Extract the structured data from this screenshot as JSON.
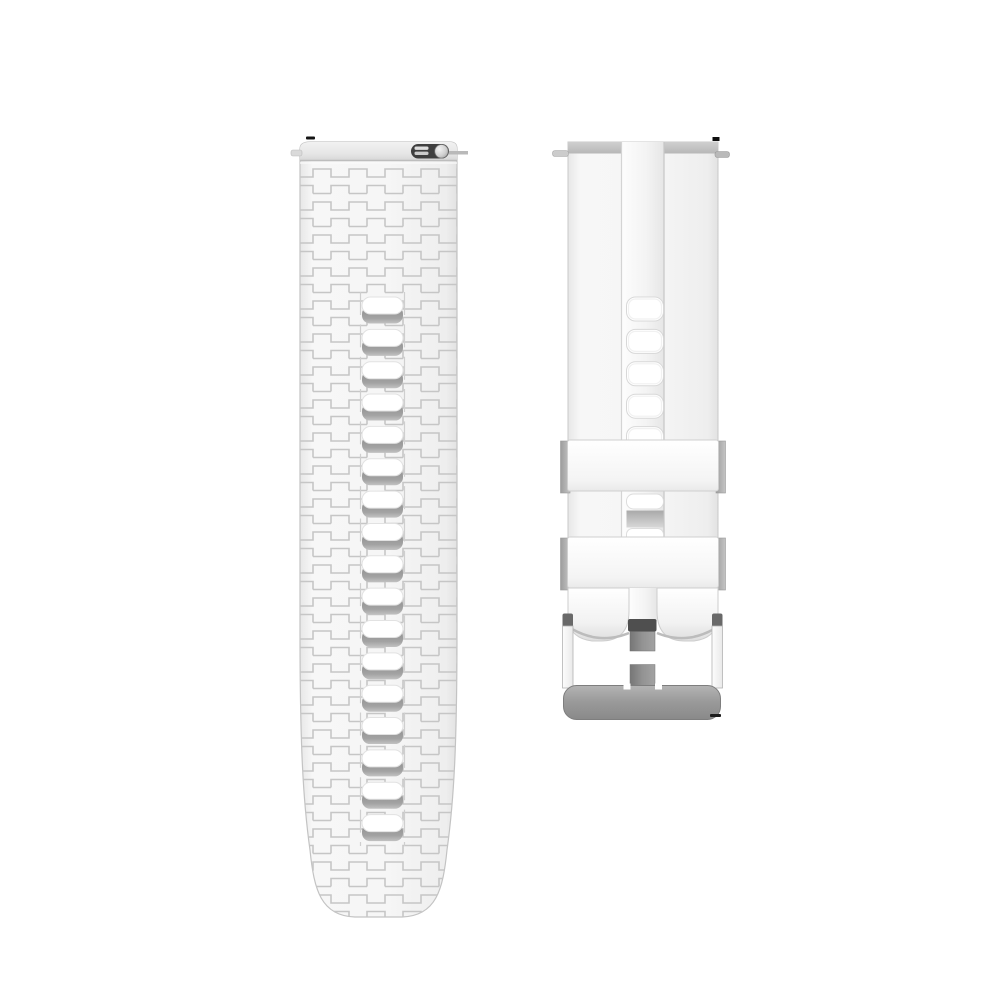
{
  "page": {
    "background_color": "#ffffff",
    "description": "Product photo: white silicone quick-release watch strap set with silver buckle"
  },
  "left_strap": {
    "material_color": "#f5f5f5",
    "texture_line_color": "#c6c6c6",
    "hole_lip_color": "#9a9a9a",
    "spring_bar_color": "#3f3f3f",
    "holes": {
      "count": 17,
      "x": 362,
      "y0": 297,
      "step": 32.35,
      "symbol": "#hole-left"
    }
  },
  "right_strap": {
    "material_color": "#f5f5f5",
    "keeper_color": "#f2f2f2",
    "keeper_tab_color": "#adadad",
    "buckle_bar_color": "#969696",
    "tongue_color": "#8f8f8f",
    "holes": {
      "count": 5,
      "x": 626.5,
      "y0": 297,
      "step": 32.4,
      "symbol": "#hole-right"
    }
  }
}
